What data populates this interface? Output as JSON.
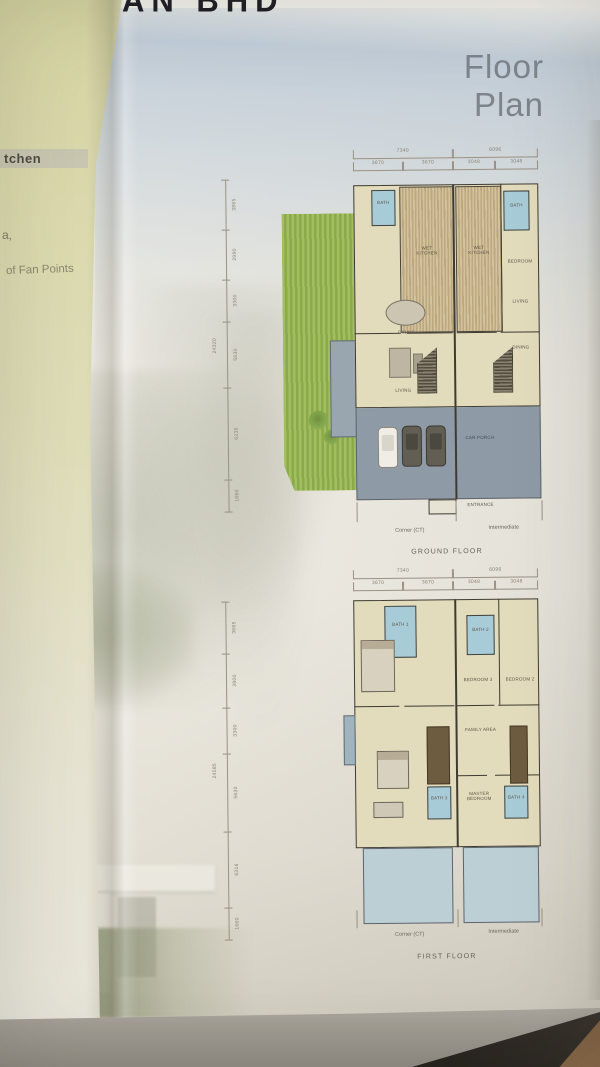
{
  "colors": {
    "page_green": "#dbd9ac",
    "sky": "#c7d1da",
    "garden_green": "#9cb85c",
    "bath_blue": "#a8cbd8",
    "car_porch_gray": "#8e9ba7",
    "room_beige": "#e2dbbc",
    "balcony_blue": "#bccfd5",
    "title_gray": "#7d848b"
  },
  "photo": {
    "top_fragment": "AN BHD",
    "left_page": {
      "fragment1": "tchen",
      "fragment2": "a,",
      "fragment3": "of Fan Points"
    },
    "title_line1": "Floor",
    "title_line2": "Plan"
  },
  "ground_floor": {
    "caption": "GROUND FLOOR",
    "footer_left": "Corner (CT)",
    "footer_right": "Intermediate",
    "dims_top_overall": [
      "7340",
      "6096"
    ],
    "dims_top_segments": [
      "3670",
      "3670",
      "3048",
      "3048"
    ],
    "dim_left_overall": "24320",
    "dims_left_segments": [
      "3865",
      "2990",
      "3300",
      "5630",
      "6235",
      "1660"
    ],
    "labels": {
      "bath_left": "BATH",
      "bath_right": "BATH",
      "wet_kitchen_left": "WET KITCHEN",
      "wet_kitchen_right": "WET KITCHEN",
      "bedroom": "BEDROOM",
      "living_right": "LIVING",
      "dining_right": "DINING",
      "dining_left": "DINING",
      "living_left": "LIVING",
      "car_porch": "CAR PORCH",
      "entrance": "ENTRANCE"
    }
  },
  "first_floor": {
    "caption": "FIRST FLOOR",
    "footer_left": "Corner (CT)",
    "footer_right": "Intermediate",
    "dims_top_overall": [
      "7340",
      "6096"
    ],
    "dims_top_segments": [
      "3670",
      "3670",
      "3048",
      "3048"
    ],
    "dim_left_overall": "24585",
    "dims_left_segments": [
      "3665",
      "3900",
      "3300",
      "5630",
      "6316",
      "1660"
    ],
    "labels": {
      "bath1": "BATH 1",
      "bath2": "BATH 2",
      "bath3": "BATH 3",
      "bath4": "BATH 4",
      "bedroom3": "BEDROOM 3",
      "bedroom2": "BEDROOM 2",
      "family": "FAMILY AREA",
      "master": "MASTER BEDROOM"
    }
  }
}
